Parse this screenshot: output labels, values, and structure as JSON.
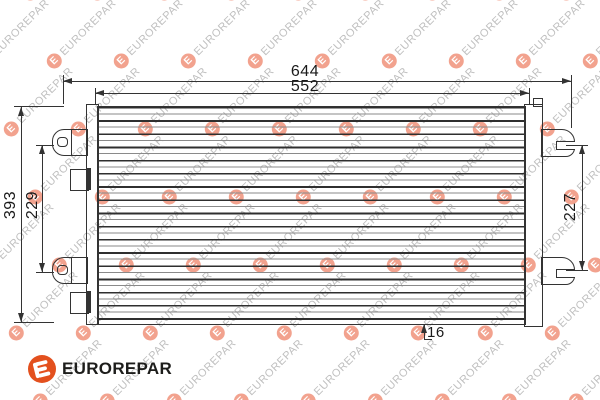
{
  "diagram": {
    "dimensions": {
      "overall_width": "644",
      "core_width": "552",
      "overall_height": "393",
      "left_mount_pitch": "229",
      "right_mount_pitch": "227",
      "depth": "16"
    }
  },
  "watermark": {
    "text": "EUROREPAR",
    "mark_letter": "E"
  },
  "logo": {
    "text": "EUROREPAR",
    "mark_letter": "E"
  },
  "colors": {
    "brand_orange": "#e3501e",
    "watermark_circle": "#f2a28e",
    "watermark_text": "#bfbfbf",
    "line": "#333333"
  }
}
